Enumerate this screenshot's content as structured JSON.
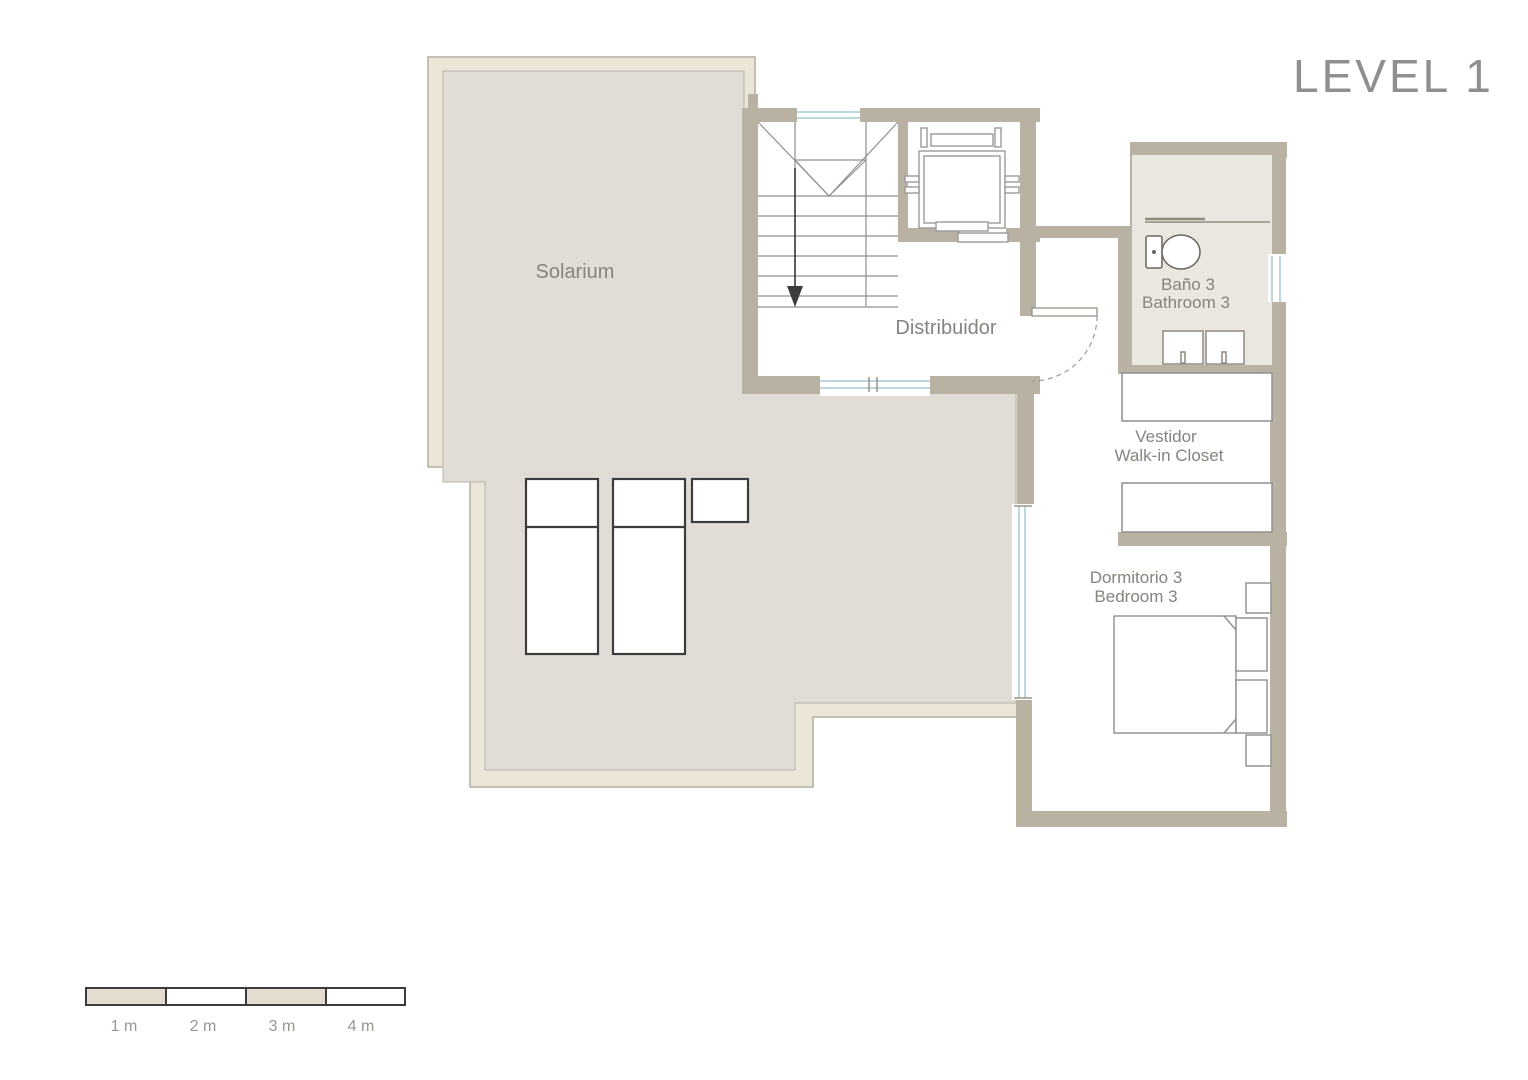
{
  "title": "LEVEL 1",
  "rooms": {
    "solarium": "Solarium",
    "distribuidor": "Distribuidor",
    "bathroom_es": "Baño 3",
    "bathroom_en": "Bathroom 3",
    "closet_es": "Vestidor",
    "closet_en": "Walk-in Closet",
    "bedroom_es": "Dormitorio 3",
    "bedroom_en": "Bedroom 3"
  },
  "scale_bar": {
    "labels": [
      "1 m",
      "2 m",
      "3 m",
      "4 m"
    ]
  },
  "colors": {
    "wall": "#b9b2a3",
    "solarium_border": "#ece6d9",
    "solarium_floor": "#e1ddd6",
    "bathroom_floor": "#eae6e0",
    "window_glass": "#bcd7de",
    "furniture_dark_outline": "#3c3c3c",
    "furniture_light_outline": "#8f8f8f",
    "label_text": "#87837d",
    "title_text": "#8f8f8f"
  }
}
